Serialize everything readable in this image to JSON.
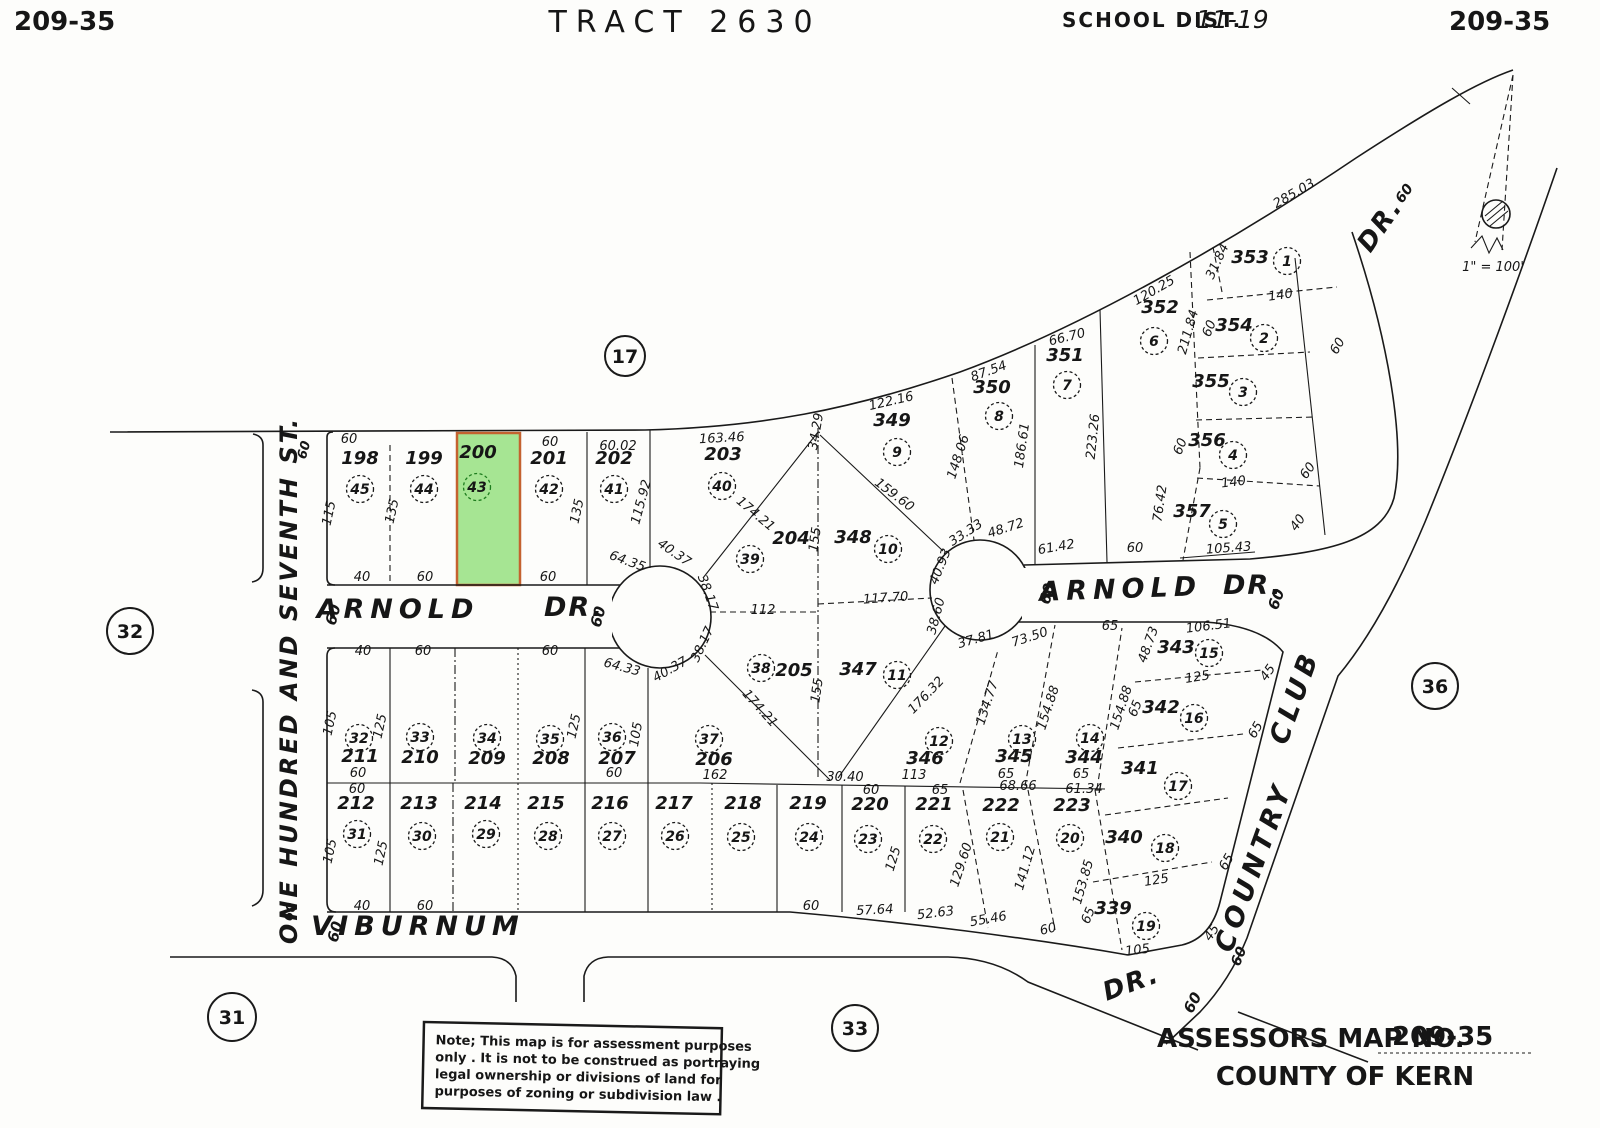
{
  "header": {
    "map_no_left": "209-35",
    "title": "TRACT 2630",
    "school_dist_label": "SCHOOL DIST.",
    "school_dist_value": "11-19",
    "map_no_right": "209-35"
  },
  "scale_text": "1\" = 100'",
  "footer": {
    "assessors_label": "ASSESSORS MAP NO.",
    "assessors_value": "209-35",
    "county": "COUNTY OF KERN"
  },
  "note": {
    "lines": [
      "Note; This map is for assessment purposes",
      "only . It is not to be construed as portraying",
      "legal ownership or divisions of land for",
      "purposes of zoning or subdivision law ."
    ]
  },
  "colors": {
    "ink": "#1a1a1a",
    "paper": "#fdfdfb",
    "highlight_fill": "#a6e593",
    "highlight_stroke": "#c4622f",
    "highlight_text": "#1e7d1e"
  },
  "selected_parcel": "200",
  "map": {
    "section_markers": [
      {
        "n": "17",
        "x": 625,
        "y": 356,
        "r": 20
      },
      {
        "n": "32",
        "x": 130,
        "y": 631,
        "r": 23
      },
      {
        "n": "31",
        "x": 232,
        "y": 1017,
        "r": 24
      },
      {
        "n": "33",
        "x": 855,
        "y": 1028,
        "r": 23
      },
      {
        "n": "36",
        "x": 1435,
        "y": 686,
        "r": 23
      }
    ],
    "street_labels": [
      {
        "t": "ARNOLD",
        "x": 398,
        "y": 618,
        "r": 0,
        "s": 27,
        "ls": 6
      },
      {
        "t": "DR.",
        "x": 574,
        "y": 616,
        "r": 0,
        "s": 27,
        "ls": 2
      },
      {
        "t": "60",
        "x": 338,
        "y": 616,
        "r": -75,
        "s": 15,
        "ls": 0
      },
      {
        "t": "60",
        "x": 603,
        "y": 618,
        "r": -75,
        "s": 15,
        "ls": 0
      },
      {
        "t": "ARNOLD",
        "x": 1121,
        "y": 598,
        "r": -2,
        "s": 27,
        "ls": 6
      },
      {
        "t": "DR.",
        "x": 1253,
        "y": 594,
        "r": 0,
        "s": 27,
        "ls": 2
      },
      {
        "t": "60",
        "x": 1052,
        "y": 595,
        "r": -75,
        "s": 15,
        "ls": 0
      },
      {
        "t": "60",
        "x": 1281,
        "y": 601,
        "r": -70,
        "s": 15,
        "ls": 0
      },
      {
        "t": "VIBURNUM",
        "x": 418,
        "y": 935,
        "r": 0,
        "s": 27,
        "ls": 6
      },
      {
        "t": "60",
        "x": 340,
        "y": 933,
        "r": -75,
        "s": 15,
        "ls": 0
      },
      {
        "t": "DR.",
        "x": 1134,
        "y": 991,
        "r": -20,
        "s": 26,
        "ls": 2
      },
      {
        "t": "60",
        "x": 1197,
        "y": 1005,
        "r": -62,
        "s": 15,
        "ls": 0
      },
      {
        "t": "ONE HUNDRED AND SEVENTH ST.",
        "x": 297,
        "y": 680,
        "r": -90,
        "s": 24,
        "ls": 3
      },
      {
        "t": "60",
        "x": 308,
        "y": 451,
        "r": -75,
        "s": 13,
        "ls": 0
      },
      {
        "t": "60",
        "x": 294,
        "y": 913,
        "r": -75,
        "s": 13,
        "ls": 0
      },
      {
        "t": "COUNTRY",
        "x": 1262,
        "y": 870,
        "r": -70,
        "s": 27,
        "ls": 5
      },
      {
        "t": "CLUB",
        "x": 1303,
        "y": 700,
        "r": -70,
        "s": 27,
        "ls": 5
      },
      {
        "t": "60",
        "x": 1243,
        "y": 958,
        "r": -68,
        "s": 14,
        "ls": 0
      },
      {
        "t": "DR.",
        "x": 1387,
        "y": 230,
        "r": -55,
        "s": 26,
        "ls": 2
      },
      {
        "t": "60",
        "x": 1408,
        "y": 196,
        "r": -55,
        "s": 14,
        "ls": 0
      }
    ],
    "parcels": [
      {
        "n": "198",
        "c": "45",
        "nx": 360,
        "ny": 464,
        "cx": 360,
        "cy": 489
      },
      {
        "n": "199",
        "c": "44",
        "nx": 424,
        "ny": 464,
        "cx": 424,
        "cy": 489
      },
      {
        "n": "200",
        "c": "43",
        "nx": 478,
        "ny": 458,
        "cx": 477,
        "cy": 487,
        "hl": true
      },
      {
        "n": "201",
        "c": "42",
        "nx": 549,
        "ny": 464,
        "cx": 549,
        "cy": 489
      },
      {
        "n": "202",
        "c": "41",
        "nx": 614,
        "ny": 464,
        "cx": 614,
        "cy": 489
      },
      {
        "n": "203",
        "c": "40",
        "nx": 723,
        "ny": 460,
        "cx": 722,
        "cy": 486
      },
      {
        "n": "204",
        "c": "39",
        "nx": 791,
        "ny": 544,
        "cx": 750,
        "cy": 559
      },
      {
        "n": "348",
        "c": "10",
        "nx": 853,
        "ny": 543,
        "cx": 888,
        "cy": 549
      },
      {
        "n": "349",
        "c": "9",
        "nx": 892,
        "ny": 426,
        "cx": 897,
        "cy": 452
      },
      {
        "n": "350",
        "c": "8",
        "nx": 992,
        "ny": 393,
        "cx": 999,
        "cy": 416
      },
      {
        "n": "351",
        "c": "7",
        "nx": 1065,
        "ny": 361,
        "cx": 1067,
        "cy": 385
      },
      {
        "n": "352",
        "c": "6",
        "nx": 1160,
        "ny": 313,
        "cx": 1154,
        "cy": 341
      },
      {
        "n": "353",
        "c": "1",
        "nx": 1250,
        "ny": 263,
        "cx": 1287,
        "cy": 261
      },
      {
        "n": "354",
        "c": "2",
        "nx": 1234,
        "ny": 331,
        "cx": 1264,
        "cy": 338
      },
      {
        "n": "355",
        "c": "3",
        "nx": 1211,
        "ny": 387,
        "cx": 1243,
        "cy": 392
      },
      {
        "n": "356",
        "c": "4",
        "nx": 1207,
        "ny": 446,
        "cx": 1233,
        "cy": 455
      },
      {
        "n": "357",
        "c": "5",
        "nx": 1192,
        "ny": 517,
        "cx": 1223,
        "cy": 524
      },
      {
        "n": "205",
        "c": "38",
        "nx": 794,
        "ny": 676,
        "cx": 761,
        "cy": 668
      },
      {
        "n": "347",
        "c": "11",
        "nx": 858,
        "ny": 675,
        "cx": 897,
        "cy": 675
      },
      {
        "n": "346",
        "c": "12",
        "nx": 925,
        "ny": 764,
        "cx": 939,
        "cy": 741
      },
      {
        "n": "345",
        "c": "13",
        "nx": 1014,
        "ny": 762,
        "cx": 1022,
        "cy": 739
      },
      {
        "n": "344",
        "c": "14",
        "nx": 1084,
        "ny": 763,
        "cx": 1090,
        "cy": 738
      },
      {
        "n": "343",
        "c": "15",
        "nx": 1176,
        "ny": 653,
        "cx": 1209,
        "cy": 653
      },
      {
        "n": "342",
        "c": "16",
        "nx": 1161,
        "ny": 713,
        "cx": 1194,
        "cy": 718
      },
      {
        "n": "341",
        "c": "17",
        "nx": 1140,
        "ny": 774,
        "cx": 1178,
        "cy": 786
      },
      {
        "n": "340",
        "c": "18",
        "nx": 1124,
        "ny": 843,
        "cx": 1165,
        "cy": 848
      },
      {
        "n": "339",
        "c": "19",
        "nx": 1113,
        "ny": 914,
        "cx": 1146,
        "cy": 926
      },
      {
        "n": "211",
        "c": "32",
        "nx": 360,
        "ny": 762,
        "cx": 359,
        "cy": 738
      },
      {
        "n": "210",
        "c": "33",
        "nx": 420,
        "ny": 763,
        "cx": 420,
        "cy": 737
      },
      {
        "n": "209",
        "c": "34",
        "nx": 487,
        "ny": 764,
        "cx": 487,
        "cy": 738
      },
      {
        "n": "208",
        "c": "35",
        "nx": 551,
        "ny": 764,
        "cx": 550,
        "cy": 739
      },
      {
        "n": "207",
        "c": "36",
        "nx": 617,
        "ny": 764,
        "cx": 612,
        "cy": 737
      },
      {
        "n": "206",
        "c": "37",
        "nx": 714,
        "ny": 765,
        "cx": 709,
        "cy": 739
      },
      {
        "n": "212",
        "c": "31",
        "nx": 356,
        "ny": 809,
        "cx": 357,
        "cy": 834
      },
      {
        "n": "213",
        "c": "30",
        "nx": 419,
        "ny": 809,
        "cx": 422,
        "cy": 836
      },
      {
        "n": "214",
        "c": "29",
        "nx": 483,
        "ny": 809,
        "cx": 486,
        "cy": 834
      },
      {
        "n": "215",
        "c": "28",
        "nx": 546,
        "ny": 809,
        "cx": 548,
        "cy": 836
      },
      {
        "n": "216",
        "c": "27",
        "nx": 610,
        "ny": 809,
        "cx": 612,
        "cy": 836
      },
      {
        "n": "217",
        "c": "26",
        "nx": 674,
        "ny": 809,
        "cx": 675,
        "cy": 836
      },
      {
        "n": "218",
        "c": "25",
        "nx": 743,
        "ny": 809,
        "cx": 741,
        "cy": 837
      },
      {
        "n": "219",
        "c": "24",
        "nx": 808,
        "ny": 809,
        "cx": 809,
        "cy": 837
      },
      {
        "n": "220",
        "c": "23",
        "nx": 870,
        "ny": 810,
        "cx": 868,
        "cy": 839
      },
      {
        "n": "221",
        "c": "22",
        "nx": 934,
        "ny": 810,
        "cx": 933,
        "cy": 839
      },
      {
        "n": "222",
        "c": "21",
        "nx": 1001,
        "ny": 811,
        "cx": 1000,
        "cy": 837
      },
      {
        "n": "223",
        "c": "20",
        "nx": 1072,
        "ny": 811,
        "cx": 1070,
        "cy": 838
      }
    ],
    "dimensions": [
      {
        "t": "60",
        "x": 349,
        "y": 443
      },
      {
        "t": "115",
        "x": 333,
        "y": 514,
        "r": -78
      },
      {
        "t": "135",
        "x": 396,
        "y": 512,
        "r": -78
      },
      {
        "t": "40",
        "x": 362,
        "y": 581
      },
      {
        "t": "60",
        "x": 425,
        "y": 581
      },
      {
        "t": "60",
        "x": 550,
        "y": 446
      },
      {
        "t": "60",
        "x": 548,
        "y": 581
      },
      {
        "t": "135",
        "x": 581,
        "y": 512,
        "r": -78
      },
      {
        "t": "60.02",
        "x": 618,
        "y": 450
      },
      {
        "t": "115.92",
        "x": 645,
        "y": 503,
        "r": -75
      },
      {
        "t": "64.35",
        "x": 626,
        "y": 565,
        "r": 20
      },
      {
        "t": "40.37",
        "x": 672,
        "y": 556,
        "r": 35
      },
      {
        "t": "38.17",
        "x": 704,
        "y": 594,
        "r": 70
      },
      {
        "t": "163.46",
        "x": 722,
        "y": 442,
        "r": -3
      },
      {
        "t": "174.21",
        "x": 753,
        "y": 517,
        "r": 40
      },
      {
        "t": "34.29",
        "x": 820,
        "y": 432,
        "r": -80
      },
      {
        "t": "155",
        "x": 819,
        "y": 540,
        "r": -82
      },
      {
        "t": "112",
        "x": 763,
        "y": 614
      },
      {
        "t": "117.70",
        "x": 886,
        "y": 602,
        "r": -4
      },
      {
        "t": "122.16",
        "x": 892,
        "y": 405,
        "r": -13
      },
      {
        "t": "159.60",
        "x": 892,
        "y": 498,
        "r": 37
      },
      {
        "t": "148.06",
        "x": 962,
        "y": 458,
        "r": -72
      },
      {
        "t": "87.54",
        "x": 990,
        "y": 375,
        "r": -20
      },
      {
        "t": "186.61",
        "x": 1026,
        "y": 446,
        "r": -82
      },
      {
        "t": "66.70",
        "x": 1068,
        "y": 341,
        "r": -14
      },
      {
        "t": "223.26",
        "x": 1097,
        "y": 437,
        "r": -84
      },
      {
        "t": "120.25",
        "x": 1156,
        "y": 294,
        "r": -30
      },
      {
        "t": "285.03",
        "x": 1296,
        "y": 197,
        "r": -30
      },
      {
        "t": "211.84",
        "x": 1192,
        "y": 333,
        "r": -74
      },
      {
        "t": "31.84",
        "x": 1221,
        "y": 263,
        "r": -65
      },
      {
        "t": "140",
        "x": 1281,
        "y": 299,
        "r": -8
      },
      {
        "t": "60",
        "x": 1213,
        "y": 330,
        "r": -68
      },
      {
        "t": "60",
        "x": 1341,
        "y": 348,
        "r": -60
      },
      {
        "t": "60",
        "x": 1184,
        "y": 448,
        "r": -68
      },
      {
        "t": "140",
        "x": 1234,
        "y": 486,
        "r": -7
      },
      {
        "t": "60",
        "x": 1311,
        "y": 473,
        "r": -55
      },
      {
        "t": "76.42",
        "x": 1164,
        "y": 504,
        "r": -82
      },
      {
        "t": "40",
        "x": 1301,
        "y": 525,
        "r": -55
      },
      {
        "t": "105.43",
        "x": 1229,
        "y": 552,
        "r": -4
      },
      {
        "t": "60",
        "x": 1135,
        "y": 552
      },
      {
        "t": "61.42",
        "x": 1057,
        "y": 551,
        "r": -10
      },
      {
        "t": "48.72",
        "x": 1007,
        "y": 532,
        "r": -18
      },
      {
        "t": "33.33",
        "x": 968,
        "y": 536,
        "r": -33
      },
      {
        "t": "40.93",
        "x": 944,
        "y": 568,
        "r": -68
      },
      {
        "t": "38.60",
        "x": 940,
        "y": 617,
        "r": -75
      },
      {
        "t": "37.81",
        "x": 977,
        "y": 643,
        "r": -16
      },
      {
        "t": "73.50",
        "x": 1031,
        "y": 641,
        "r": -18
      },
      {
        "t": "64.33",
        "x": 621,
        "y": 671,
        "r": 15
      },
      {
        "t": "40.37",
        "x": 672,
        "y": 673,
        "r": -30
      },
      {
        "t": "38.17",
        "x": 706,
        "y": 646,
        "r": -65
      },
      {
        "t": "155",
        "x": 821,
        "y": 691,
        "r": -82
      },
      {
        "t": "174.21",
        "x": 757,
        "y": 711,
        "r": 48
      },
      {
        "t": "176.32",
        "x": 929,
        "y": 698,
        "r": -46
      },
      {
        "t": "30.40",
        "x": 845,
        "y": 781
      },
      {
        "t": "113",
        "x": 914,
        "y": 779
      },
      {
        "t": "134.77",
        "x": 991,
        "y": 704,
        "r": -72
      },
      {
        "t": "154.88",
        "x": 1052,
        "y": 709,
        "r": -72
      },
      {
        "t": "65",
        "x": 1139,
        "y": 710,
        "r": -68
      },
      {
        "t": "154.88",
        "x": 1125,
        "y": 709,
        "r": -72
      },
      {
        "t": "65",
        "x": 1110,
        "y": 630
      },
      {
        "t": "48.73",
        "x": 1152,
        "y": 646,
        "r": -70
      },
      {
        "t": "106.51",
        "x": 1209,
        "y": 630,
        "r": -7
      },
      {
        "t": "125",
        "x": 1198,
        "y": 681,
        "r": -9
      },
      {
        "t": "45",
        "x": 1271,
        "y": 675,
        "r": -55
      },
      {
        "t": "65",
        "x": 1259,
        "y": 732,
        "r": -60
      },
      {
        "t": "125",
        "x": 1157,
        "y": 884,
        "r": -9
      },
      {
        "t": "65",
        "x": 1230,
        "y": 864,
        "r": -60
      },
      {
        "t": "45",
        "x": 1215,
        "y": 935,
        "r": -55
      },
      {
        "t": "105",
        "x": 1138,
        "y": 954,
        "r": -7
      },
      {
        "t": "65",
        "x": 1092,
        "y": 917,
        "r": -68
      },
      {
        "t": "40",
        "x": 363,
        "y": 655
      },
      {
        "t": "60",
        "x": 423,
        "y": 655
      },
      {
        "t": "60",
        "x": 550,
        "y": 655
      },
      {
        "t": "105",
        "x": 334,
        "y": 724,
        "r": -78
      },
      {
        "t": "125",
        "x": 384,
        "y": 727,
        "r": -78
      },
      {
        "t": "125",
        "x": 578,
        "y": 727,
        "r": -78
      },
      {
        "t": "105",
        "x": 640,
        "y": 735,
        "r": -80
      },
      {
        "t": "60",
        "x": 358,
        "y": 777
      },
      {
        "t": "60",
        "x": 614,
        "y": 777
      },
      {
        "t": "162",
        "x": 715,
        "y": 779
      },
      {
        "t": "60",
        "x": 357,
        "y": 793
      },
      {
        "t": "105",
        "x": 334,
        "y": 852,
        "r": -78
      },
      {
        "t": "125",
        "x": 385,
        "y": 854,
        "r": -78
      },
      {
        "t": "40",
        "x": 362,
        "y": 910
      },
      {
        "t": "60",
        "x": 425,
        "y": 910
      },
      {
        "t": "60",
        "x": 811,
        "y": 910
      },
      {
        "t": "60",
        "x": 871,
        "y": 794
      },
      {
        "t": "125",
        "x": 897,
        "y": 860,
        "r": -73
      },
      {
        "t": "65",
        "x": 940,
        "y": 794
      },
      {
        "t": "65",
        "x": 1006,
        "y": 778
      },
      {
        "t": "68.66",
        "x": 1018,
        "y": 790
      },
      {
        "t": "65",
        "x": 1081,
        "y": 778
      },
      {
        "t": "61.34",
        "x": 1084,
        "y": 793
      },
      {
        "t": "129.60",
        "x": 965,
        "y": 866,
        "r": -72
      },
      {
        "t": "141.12",
        "x": 1029,
        "y": 869,
        "r": -74
      },
      {
        "t": "153.85",
        "x": 1087,
        "y": 883,
        "r": -74
      },
      {
        "t": "57.64",
        "x": 875,
        "y": 914,
        "r": -3
      },
      {
        "t": "52.63",
        "x": 936,
        "y": 917,
        "r": -7
      },
      {
        "t": "55.46",
        "x": 989,
        "y": 923,
        "r": -10
      },
      {
        "t": "60",
        "x": 1049,
        "y": 933,
        "r": -14
      }
    ]
  }
}
